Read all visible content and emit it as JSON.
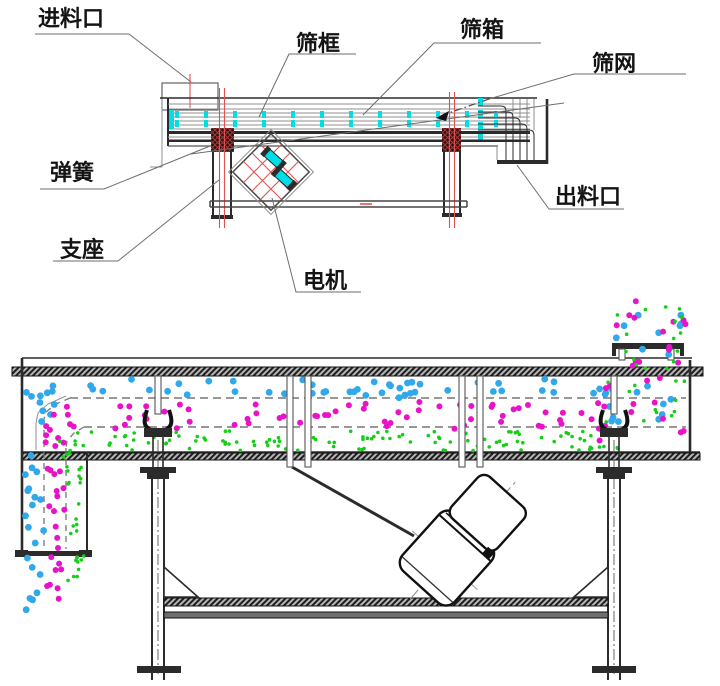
{
  "diagram": {
    "kind": "linear vibrating screen technical diagram",
    "views": [
      "labeled side schematic",
      "material flow cross-section"
    ]
  },
  "labels": {
    "feed_inlet": "进料口",
    "screen_frame": "筛框",
    "screen_box": "筛箱",
    "screen_mesh": "筛网",
    "spring": "弹簧",
    "support": "支座",
    "motor": "电机",
    "discharge_outlet": "出料口"
  },
  "colors": {
    "line": "#2b2b2b",
    "gray": "#8f8f8f",
    "red": "#e05252",
    "cyan": "#00dde6",
    "blue": "#2fa8ec",
    "magenta": "#e813c8",
    "green": "#17ce17"
  },
  "particles": {
    "palette": {
      "coarse": "#2fa8ec",
      "medium": "#e813c8",
      "fine": "#17ce17"
    },
    "legend": [
      {
        "name": "coarse-particles",
        "color": "#2fa8ec"
      },
      {
        "name": "medium-particles",
        "color": "#e813c8"
      },
      {
        "name": "fine-particles",
        "color": "#17ce17"
      }
    ],
    "regions": [
      {
        "layer": "coarse",
        "x": 50,
        "y": 379,
        "w": 556,
        "h": 19,
        "n": 48,
        "r": 3.4
      },
      {
        "layer": "coarse",
        "x": 24,
        "y": 382,
        "w": 34,
        "h": 42,
        "n": 10,
        "r": 3.4
      },
      {
        "layer": "coarse",
        "x": 25,
        "y": 424,
        "w": 19,
        "h": 126,
        "n": 13,
        "r": 3.4
      },
      {
        "layer": "coarse",
        "x": 25,
        "y": 557,
        "w": 18,
        "h": 56,
        "n": 7,
        "r": 3.4
      },
      {
        "layer": "coarse",
        "x": 596,
        "y": 378,
        "w": 90,
        "h": 44,
        "n": 12,
        "r": 3.4
      },
      {
        "layer": "coarse",
        "x": 616,
        "y": 304,
        "w": 66,
        "h": 66,
        "n": 9,
        "r": 3.4
      },
      {
        "layer": "medium",
        "x": 66,
        "y": 402,
        "w": 540,
        "h": 27,
        "n": 62,
        "r": 3
      },
      {
        "layer": "medium",
        "x": 40,
        "y": 408,
        "w": 28,
        "h": 40,
        "n": 9,
        "r": 3
      },
      {
        "layer": "medium",
        "x": 46,
        "y": 448,
        "w": 19,
        "h": 102,
        "n": 13,
        "r": 3
      },
      {
        "layer": "medium",
        "x": 46,
        "y": 556,
        "w": 18,
        "h": 50,
        "n": 8,
        "r": 3
      },
      {
        "layer": "medium",
        "x": 612,
        "y": 300,
        "w": 74,
        "h": 72,
        "n": 14,
        "r": 3
      },
      {
        "layer": "medium",
        "x": 596,
        "y": 376,
        "w": 92,
        "h": 86,
        "n": 13,
        "r": 3
      },
      {
        "layer": "fine",
        "x": 76,
        "y": 431,
        "w": 530,
        "h": 20,
        "n": 108,
        "r": 1.8
      },
      {
        "layer": "fine",
        "x": 58,
        "y": 438,
        "w": 20,
        "h": 24,
        "n": 7,
        "r": 1.8
      },
      {
        "layer": "fine",
        "x": 66,
        "y": 460,
        "w": 18,
        "h": 90,
        "n": 15,
        "r": 1.8
      },
      {
        "layer": "fine",
        "x": 67,
        "y": 556,
        "w": 17,
        "h": 46,
        "n": 10,
        "r": 1.8
      },
      {
        "layer": "fine",
        "x": 614,
        "y": 303,
        "w": 70,
        "h": 70,
        "n": 16,
        "r": 1.8
      },
      {
        "layer": "fine",
        "x": 600,
        "y": 378,
        "w": 88,
        "h": 82,
        "n": 16,
        "r": 1.8
      }
    ]
  }
}
